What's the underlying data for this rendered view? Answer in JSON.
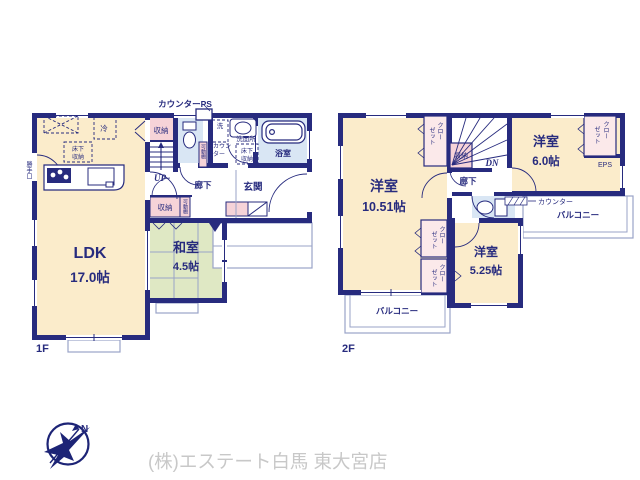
{
  "colors": {
    "wall_navy": "#272b7e",
    "room_cream": "#fbeccb",
    "tatami_green": "#dfe8c4",
    "storage_pink": "#f6d3d8",
    "closet_pink": "#fbe9ea",
    "wet_blue": "#d9e6f4",
    "thin_line": "#9aa3c7",
    "footer_gray": "#c8c8c8"
  },
  "floor1": {
    "label": "1F",
    "counter_ps": "カウンターPS",
    "rooms": {
      "ldk": {
        "name": "LDK",
        "area": "17.0帖"
      },
      "washitsu": {
        "name": "和室",
        "area": "4.5帖"
      },
      "genkan": "玄関",
      "rouka": "廊下",
      "yokushitsu": "浴室",
      "senmenjo": "洗面所"
    },
    "labels": {
      "shuno_top": "収納",
      "shuno_bottom": "収納",
      "kado_tana": "可動棚",
      "kado_tana_2": "可動棚",
      "rei": "冷",
      "yukashita_kitchen": [
        "床下",
        "収納"
      ],
      "yukashita_senmen": [
        "床下",
        "収納"
      ],
      "sen": "洗",
      "counter": [
        "カウン",
        "ター"
      ],
      "katteguchi": "勝手口",
      "up": "UP"
    }
  },
  "floor2": {
    "label": "2F",
    "rooms": {
      "west": {
        "name": "洋室",
        "area": "10.51帖"
      },
      "northeast": {
        "name": "洋室",
        "area": "6.0帖"
      },
      "southeast": {
        "name": "洋室",
        "area": "5.25帖"
      },
      "rouka": "廊下"
    },
    "labels": {
      "closet_stairs": [
        "クロー",
        "ゼット"
      ],
      "closet_northeast": [
        "クロー",
        "ゼット"
      ],
      "closet_mid_upper": [
        "クロー",
        "ゼット"
      ],
      "closet_mid_lower": [
        "クロー",
        "ゼット"
      ],
      "shuno": "収納",
      "dn": "DN",
      "eps": "EPS",
      "counter": "カウンター",
      "balcony_east": "バルコニー",
      "balcony_south": "バルコニー"
    }
  },
  "footer": {
    "company": "(株)エステート白馬 東大宮店",
    "compass_n": "N"
  }
}
